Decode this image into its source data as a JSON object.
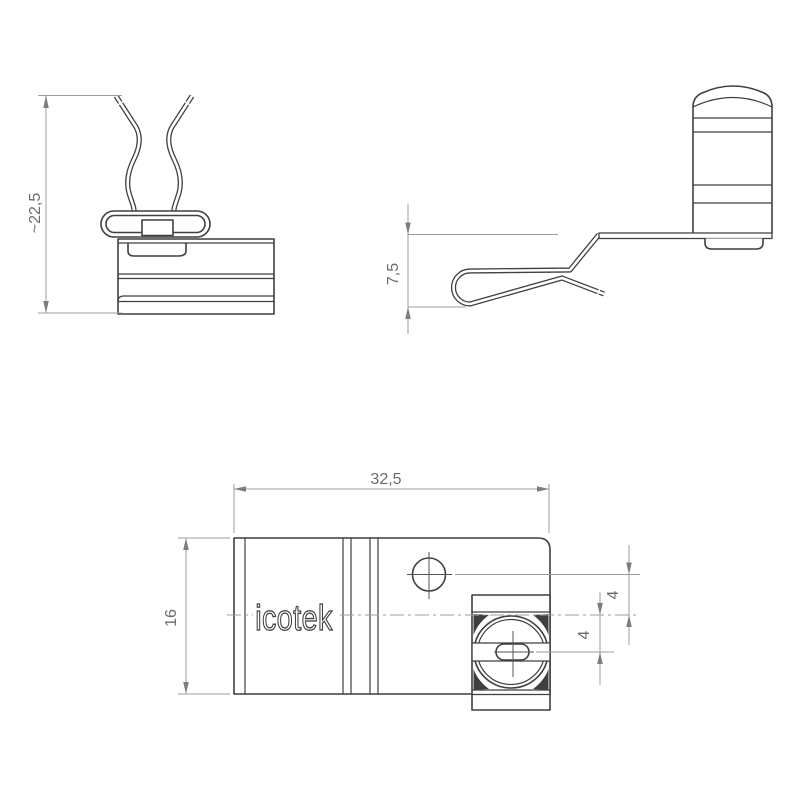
{
  "drawing": {
    "logo_text": "icotek",
    "front_view": {
      "height_label": "~22,5"
    },
    "side_view": {
      "height_label": "7,5"
    },
    "top_view": {
      "width_label": "32,5",
      "depth_label": "16",
      "hole_offset_label": "4",
      "slot_offset_label": "4"
    },
    "colors": {
      "background": "#ffffff",
      "part_line": "#3f3f3f",
      "dimension_line": "#9c9c9c",
      "label_text": "#6b6b6b"
    }
  }
}
